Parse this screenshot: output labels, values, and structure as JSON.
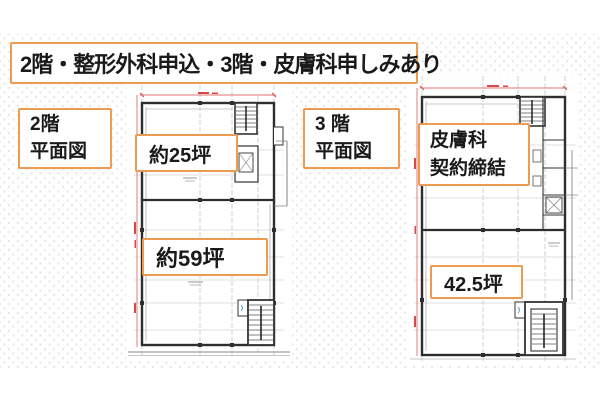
{
  "title_banner": {
    "text": "2階・整形外科申込・3階・皮膚科申しみあり"
  },
  "plans": {
    "second_floor": {
      "caption_line1": "2階",
      "caption_line2": "平面図",
      "area_upper": "約25坪",
      "area_lower": "約59坪"
    },
    "third_floor": {
      "caption_line1": "3 階",
      "caption_line2": "平面図",
      "status_line1": "皮膚科",
      "status_line2": "契約締結",
      "area": "42.5坪"
    }
  },
  "colors": {
    "accent_orange": "#ED9A52",
    "dimension_red": "#D84848",
    "dimension_line_red": "#E07070",
    "wall_dark": "#2E2E2E",
    "grid_gray": "#CCC4C4",
    "door_blue": "#4AA8C8"
  }
}
